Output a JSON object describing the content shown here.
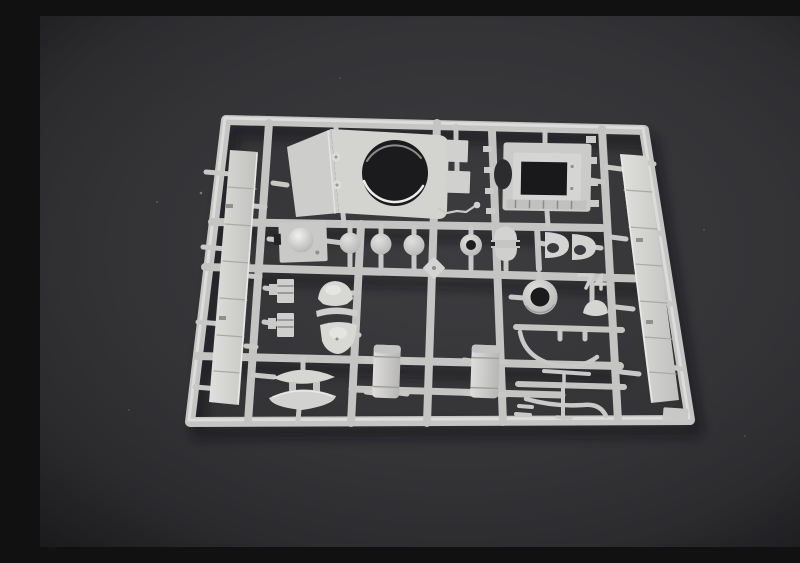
{
  "image": {
    "type": "product-photograph",
    "subject": "Light grey injection-molded plastic model kit sprue (parts tree) with armored-vehicle components, photographed at a slight angle on a dark grey studio background",
    "caption": "Unassembled model kit sprue of tank parts on dark background",
    "palette": {
      "background_dark": "#232326",
      "background_mid": "#3c3c3f",
      "plastic_base": "#c9c9c7",
      "plastic_highlight": "#e9e9e7",
      "plastic_shadow": "#9a9a98",
      "hole_dark": "#1b1b1e"
    },
    "parts": [
      {
        "name": "turret-shell-with-round-opening"
      },
      {
        "name": "hatch-frame-with-square-opening"
      },
      {
        "name": "left-fender-strip"
      },
      {
        "name": "right-fender-strip"
      },
      {
        "name": "hatch-plate-with-dome"
      },
      {
        "name": "road-wheel-disc-1"
      },
      {
        "name": "road-wheel-disc-2"
      },
      {
        "name": "road-wheel-disc-3"
      },
      {
        "name": "ring-washer"
      },
      {
        "name": "capstan-wheel-with-band"
      },
      {
        "name": "half-cup-housing-1"
      },
      {
        "name": "half-cup-housing-2"
      },
      {
        "name": "turret-ring"
      },
      {
        "name": "small-dome-shell"
      },
      {
        "name": "periscope-half-dome"
      },
      {
        "name": "curved-visor-bar"
      },
      {
        "name": "mantlet-dome"
      },
      {
        "name": "ribbed-block-1"
      },
      {
        "name": "ribbed-block-2"
      },
      {
        "name": "fuel-tank-box-1"
      },
      {
        "name": "fuel-tank-box-2"
      },
      {
        "name": "lens-hatch-upper"
      },
      {
        "name": "lens-hatch-lower"
      },
      {
        "name": "antenna-wire"
      },
      {
        "name": "exhaust-pipe-curve-1"
      },
      {
        "name": "exhaust-pipe-curve-2"
      },
      {
        "name": "small-bracket-pair"
      },
      {
        "name": "small-rect-plate-1"
      },
      {
        "name": "small-rect-plate-2"
      },
      {
        "name": "sprue-frame-and-runners"
      }
    ]
  }
}
